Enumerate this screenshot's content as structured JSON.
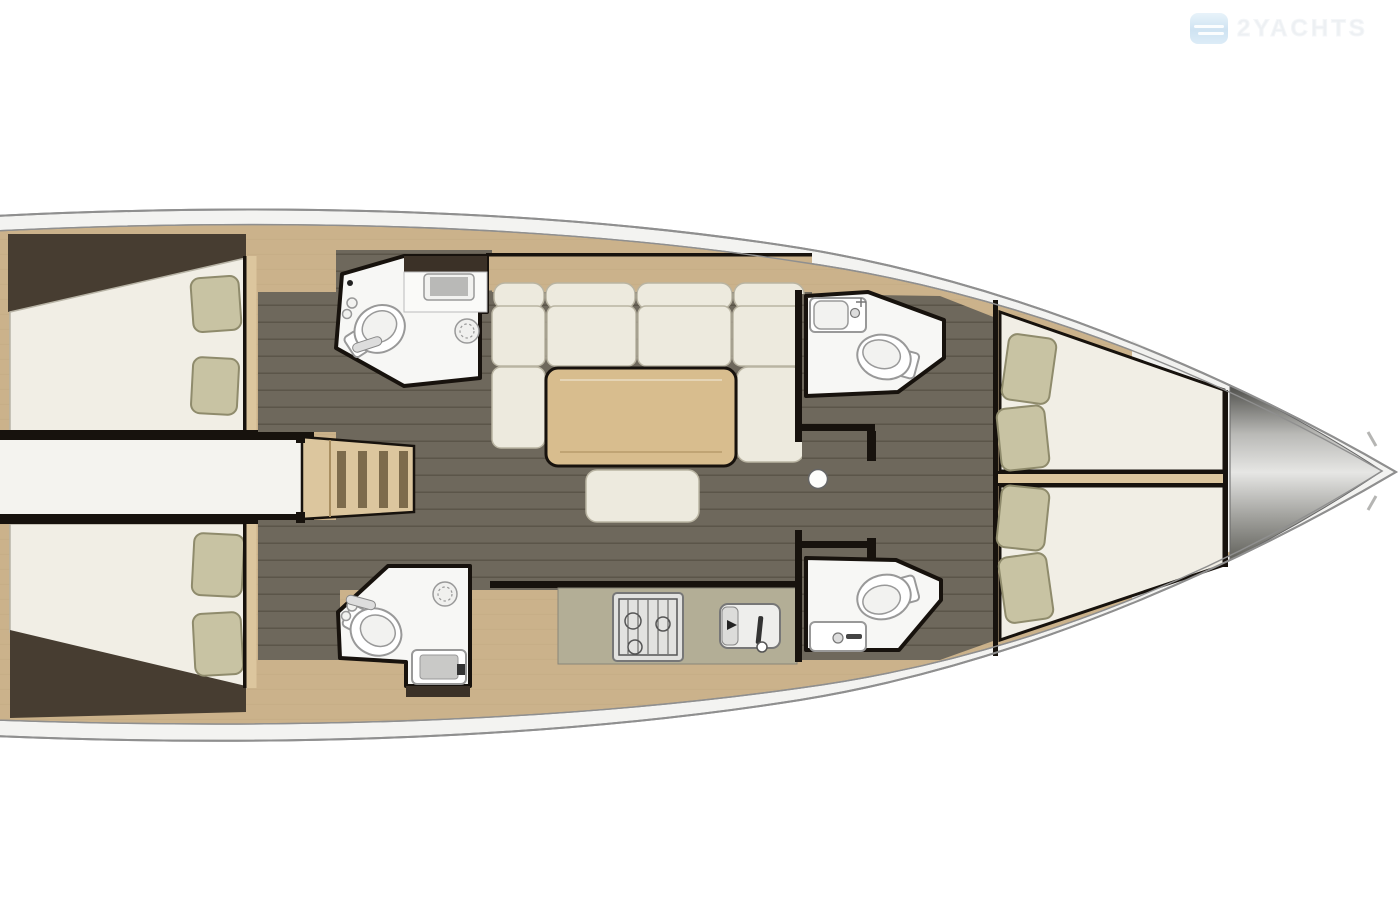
{
  "watermark": {
    "brand_text": "2YACHTS",
    "icon": "waves-logo-icon",
    "icon_color": "#cfe3f2",
    "text_color": "#edf0f3"
  },
  "palette": {
    "pageBg": "#ffffff",
    "hullBand": "#f3f3f1",
    "hullStroke": "#8f8f8f",
    "wood": "#cbb28b",
    "woodLight": "#dcc69e",
    "woodSeam": "#b59b73",
    "wall": "#17120d",
    "wedge": "#473d31",
    "floorBase": "#6e685c",
    "floorLine": "#5b5549",
    "mattress": "#f1eee5",
    "mattressEdge": "#b8b4a6",
    "pillow": "#c8c3a3",
    "pillowEdge": "#8f8b6c",
    "cushion": "#edeade",
    "cushionEdge": "#b9b4a2",
    "tableTop": "#d8bd8e",
    "counter": "#b3ae96",
    "bath": "#f7f7f5",
    "fixture": "#999999",
    "logoBlue": "#cfe3f2",
    "logoText": "#edf0f3"
  },
  "floor_plan": {
    "type": "sailing-yacht-interior-plan-top-view",
    "orientation": "bow-right",
    "areas": [
      {
        "id": "aft-cabin-port",
        "furniture": [
          "double-bed",
          "pillow",
          "pillow"
        ]
      },
      {
        "id": "aft-corridor",
        "furniture": []
      },
      {
        "id": "aft-cabin-starboard",
        "furniture": [
          "double-bed",
          "pillow",
          "pillow"
        ]
      },
      {
        "id": "head-aft-port",
        "furniture": [
          "toilet",
          "sink-vanity",
          "shower-drain"
        ]
      },
      {
        "id": "head-aft-starboard",
        "furniture": [
          "toilet",
          "sink-vanity",
          "shower-drain"
        ]
      },
      {
        "id": "companionway-stairs",
        "furniture": [
          "ladder-treads"
        ]
      },
      {
        "id": "saloon",
        "furniture": [
          "u-sofa",
          "dining-table",
          "bench-seat"
        ]
      },
      {
        "id": "galley",
        "furniture": [
          "stove-3-burner",
          "double-sink"
        ]
      },
      {
        "id": "mast-post",
        "furniture": []
      },
      {
        "id": "head-fwd-port",
        "furniture": [
          "sink-vanity",
          "toilet"
        ]
      },
      {
        "id": "head-fwd-starboard",
        "furniture": [
          "toilet",
          "sink-vanity"
        ]
      },
      {
        "id": "forward-cabin",
        "furniture": [
          "bed",
          "bed",
          "pillow",
          "pillow",
          "pillow",
          "pillow"
        ]
      },
      {
        "id": "bow-anchor-locker",
        "furniture": []
      }
    ]
  }
}
